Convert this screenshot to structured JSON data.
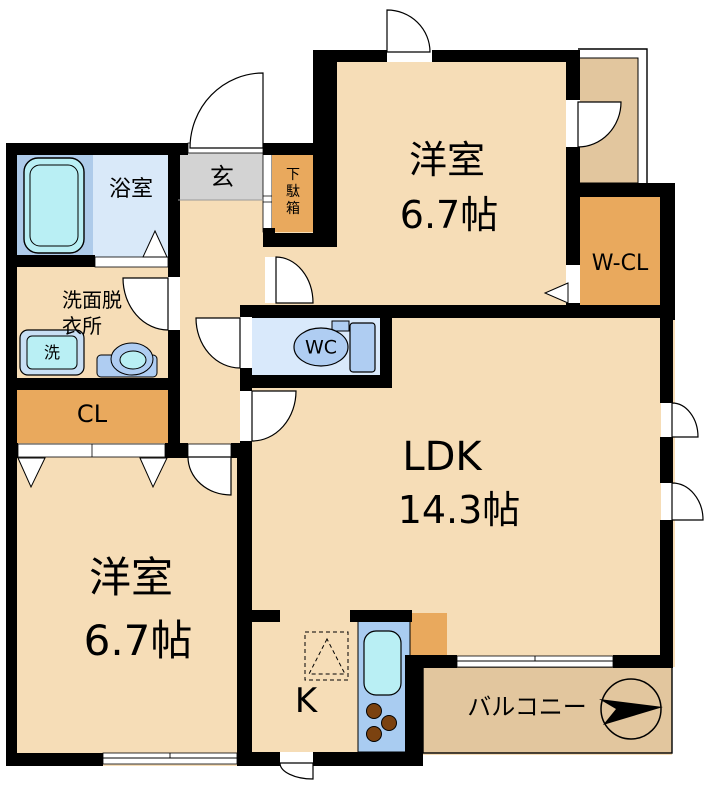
{
  "rooms": {
    "bathroom": {
      "label": "浴室"
    },
    "washroom": {
      "lines": [
        "洗面脱",
        "衣所"
      ]
    },
    "washing_machine": {
      "label": "洗"
    },
    "entrance": {
      "label": "玄"
    },
    "shoe_cabinet": {
      "label": "下駄箱"
    },
    "closet": {
      "label": "CL"
    },
    "bedroom_north": {
      "label": "洋室",
      "size": "6.7帖"
    },
    "walk_in_closet": {
      "label": "W-CL"
    },
    "toilet": {
      "label": "WC"
    },
    "ldk": {
      "label": "LDK",
      "size": "14.3帖"
    },
    "bedroom_south": {
      "label": "洋室",
      "size": "6.7帖"
    },
    "kitchen": {
      "label": "K"
    },
    "balcony": {
      "label": "バルコニー"
    }
  },
  "colors": {
    "floor_beige": "#F6DDB7",
    "balcony_tan": "#E2C69E",
    "closet_orange": "#E9A95D",
    "entrance_gray": "#D3D3D3",
    "bathroom_blue": "#D9E9F9",
    "tub_panel_blue": "#AECBEA",
    "toilet_room_blue": "#D9E9FB",
    "fixture_blue": "#AFCDF2",
    "fixture_cyan": "#B9EFF4",
    "counter_blue": "#A9CCF1",
    "burner_brown": "#7B4210",
    "wall_black": "#000000"
  }
}
